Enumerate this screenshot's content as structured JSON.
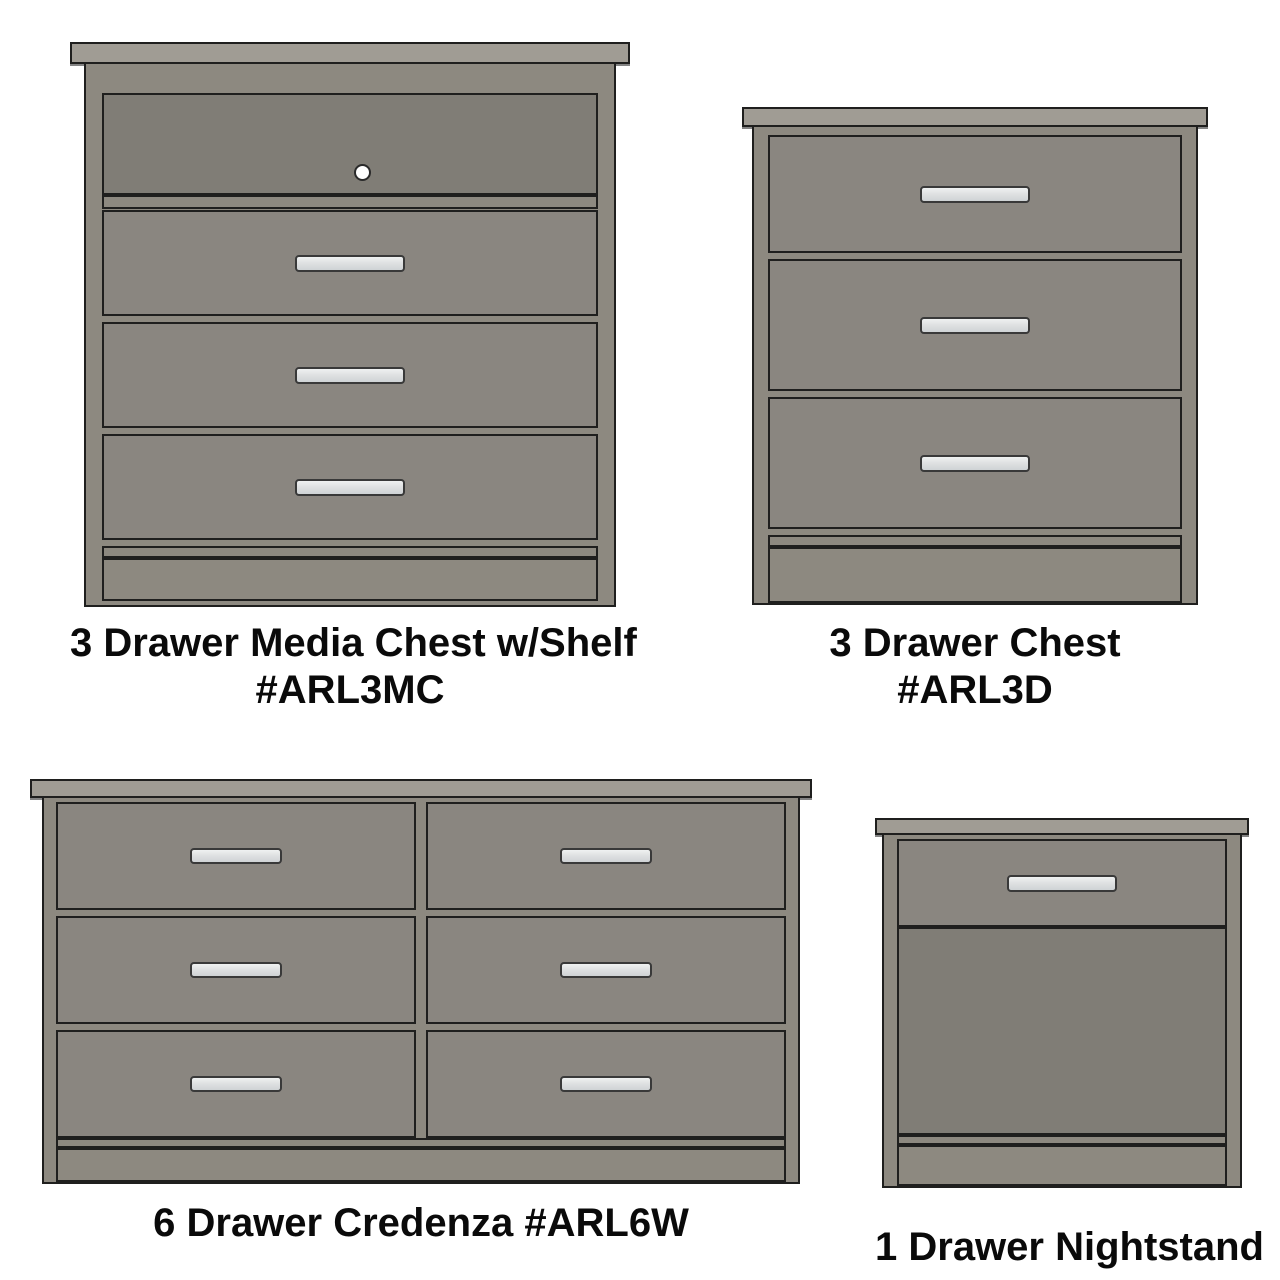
{
  "colors": {
    "background": "#ffffff",
    "line": "#1f1f1e",
    "cap": "#a09c94",
    "frame": "#8d8980",
    "drawer": "#8a8680",
    "panel": "#807d76",
    "handle": "#dfe1e2",
    "text": "#0a0a0a"
  },
  "products": {
    "media_chest": {
      "name": "3 Drawer Media Chest w/Shelf",
      "model": "#ARL3MC",
      "drawer_count": "3"
    },
    "chest": {
      "name": "3 Drawer Chest",
      "model": "#ARL3D",
      "drawer_count": "3"
    },
    "credenza": {
      "name": "6 Drawer Credenza #ARL6W",
      "drawer_count": "6"
    },
    "nightstand": {
      "name": "1 Drawer Nightstand",
      "drawer_count": "1"
    }
  }
}
